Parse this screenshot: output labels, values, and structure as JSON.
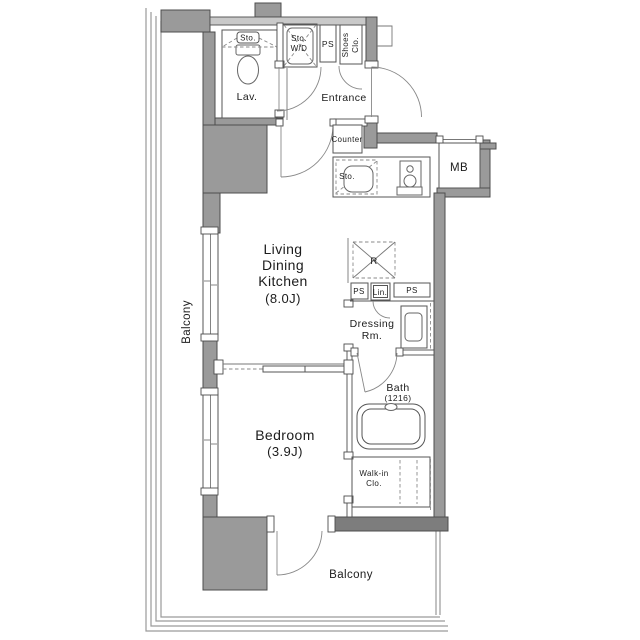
{
  "title": "1K Apartment Floor Plan",
  "colors": {
    "wall": "#9a9a9a",
    "wall_dark": "#7d7d7d",
    "wall_light": "#c9c9c9",
    "line": "#555555",
    "text": "#1c1c1c",
    "background": "#ffffff"
  },
  "labels": {
    "sto_top": "Sto.",
    "lav": "Lav.",
    "sto_wd_line1": "Sto.",
    "sto_wd_line2": "W/D",
    "ps_top": "PS",
    "shoes_line1": "Shoes",
    "shoes_line2": "Clo.",
    "entrance": "Entrance",
    "counter": "Counter",
    "kitchen_sto": "Sto.",
    "mb": "MB",
    "ldk_line1": "Living",
    "ldk_line2": "Dining",
    "ldk_line3": "Kitchen",
    "ldk_line4": "(8.0J)",
    "fridge": "R",
    "ps_mid_left": "PS",
    "linen": "Lin.",
    "ps_mid_right": "PS",
    "dressing_line1": "Dressing",
    "dressing_line2": "Rm.",
    "bath": "Bath",
    "bath_size": "(1216)",
    "walkin_line1": "Walk-in",
    "walkin_line2": "Clo.",
    "bedroom": "Bedroom",
    "bedroom_size": "(3.9J)",
    "balcony_left": "Balcony",
    "balcony_bottom": "Balcony"
  }
}
